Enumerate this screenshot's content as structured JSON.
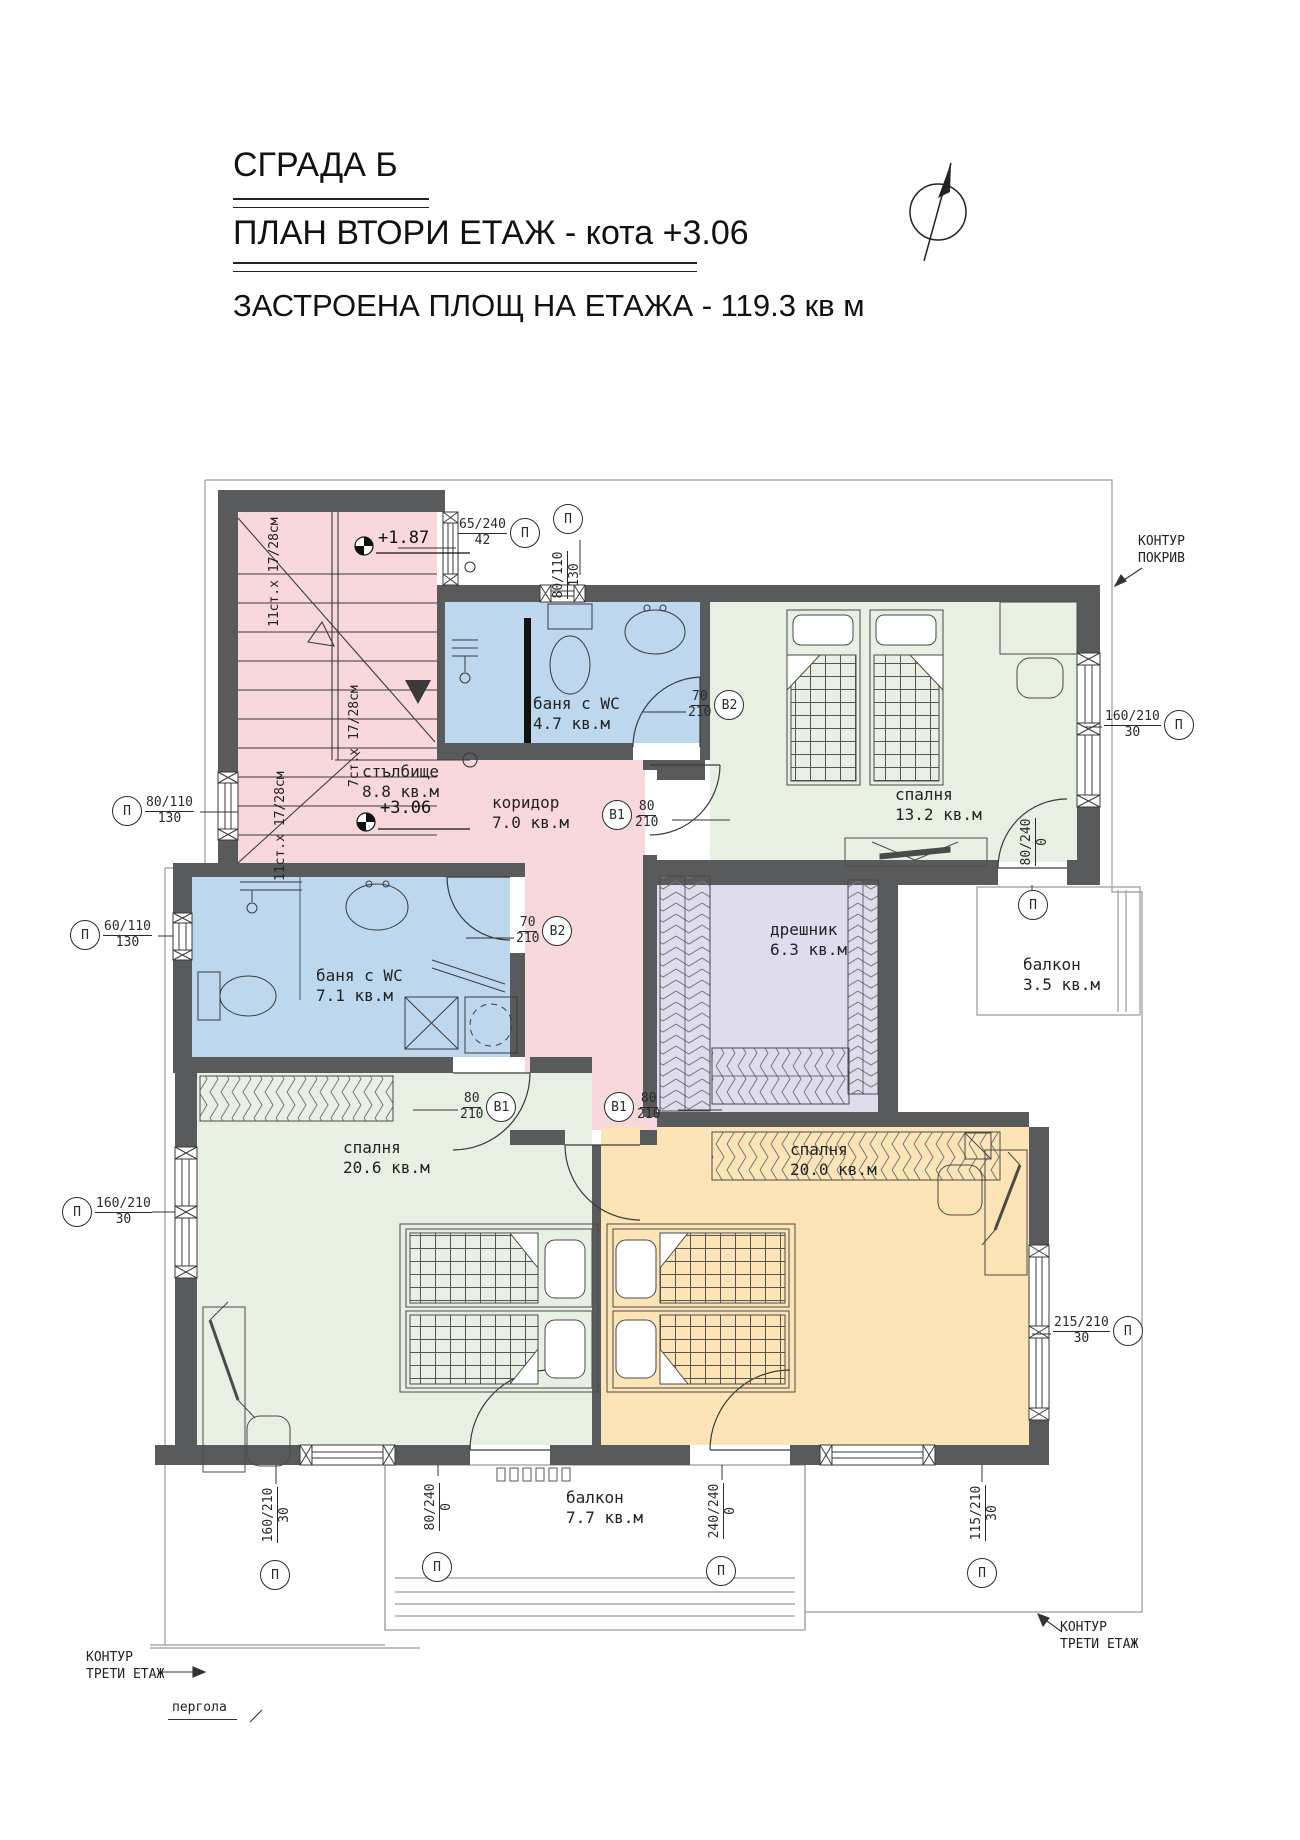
{
  "header": {
    "building": "СГРАДА Б",
    "plan": "ПЛАН ВТОРИ ЕТАЖ - кота +3.06",
    "area": "ЗАСТРОЕНА ПЛОЩ НА ЕТАЖА - 119.3 кв м"
  },
  "rooms": {
    "stair": {
      "name": "стълбище",
      "area": "8.8 кв.м"
    },
    "corridor": {
      "name": "коридор",
      "area": "7.0 кв.м"
    },
    "bath1": {
      "name": "баня с WC",
      "area": "4.7 кв.м"
    },
    "bath2": {
      "name": "баня с WC",
      "area": "7.1 кв.м"
    },
    "bedroom1": {
      "name": "спалня",
      "area": "13.2 кв.м"
    },
    "closet": {
      "name": "дрешник",
      "area": "6.3 кв.м"
    },
    "balcony1": {
      "name": "балкон",
      "area": "3.5 кв.м"
    },
    "bedroom2": {
      "name": "спалня",
      "area": "20.6 кв.м"
    },
    "bedroom3": {
      "name": "спалня",
      "area": "20.0 кв.м"
    },
    "balcony2": {
      "name": "балкон",
      "area": "7.7 кв.м"
    }
  },
  "levels": {
    "stair_landing": "+1.87",
    "floor": "+3.06"
  },
  "stairs": {
    "note_upper": "11ст.х 17/28см",
    "note_mid": "7ст.х 17/28см",
    "note_lower": "11ст.х 17/28см"
  },
  "dims": {
    "d1": {
      "t": "65/240",
      "b": "42",
      "bub": "П"
    },
    "d2": {
      "t": "80/110",
      "b": "130",
      "bub": "П"
    },
    "d3": {
      "t": "80/110",
      "b": "130",
      "bub": "П"
    },
    "d4": {
      "t": "60/110",
      "b": "130",
      "bub": "П"
    },
    "d5": {
      "t": "160/210",
      "b": "30",
      "bub": "П"
    },
    "d6": {
      "t": "70",
      "b": "210",
      "bub": "В2"
    },
    "d7": {
      "t": "70",
      "b": "210",
      "bub": "В2"
    },
    "d8": {
      "t": "80",
      "b": "210",
      "bub": "В1"
    },
    "d9": {
      "t": "80",
      "b": "210",
      "bub": "В1"
    },
    "d10": {
      "t": "80",
      "b": "210",
      "bub": "В1"
    },
    "d11": {
      "t": "160/210",
      "b": "30",
      "bub": "П"
    },
    "d12": {
      "t": "80/240",
      "b": "0",
      "bub": "П"
    },
    "d13": {
      "t": "215/210",
      "b": "30",
      "bub": "П"
    },
    "d14": {
      "t": "115/210",
      "b": "30",
      "bub": "П"
    },
    "d15": {
      "t": "240/240",
      "b": "0",
      "bub": "П"
    },
    "d16": {
      "t": "80/240",
      "b": "0",
      "bub": "П"
    },
    "d17": {
      "t": "160/210",
      "b": "30",
      "bub": "П"
    }
  },
  "notes": {
    "roof_line1": "КОНТУР",
    "roof_line2": "ПОКРИВ",
    "third_bl_line1": "КОНТУР",
    "third_bl_line2": "ТРЕТИ ЕТАЖ",
    "third_br_line1": "КОНТУР",
    "third_br_line2": "ТРЕТИ ЕТАЖ",
    "pergola": "пергола"
  },
  "colors": {
    "wall": "#595a5c",
    "stair_corridor_fill": "#f8d8dc",
    "bath_fill": "#bdd7ef",
    "bedroom_green_fill": "#e8f0e3",
    "bedroom_orange_fill": "#fce4b6",
    "closet_fill": "#dfdcee",
    "linework": "#3a3a3a"
  }
}
